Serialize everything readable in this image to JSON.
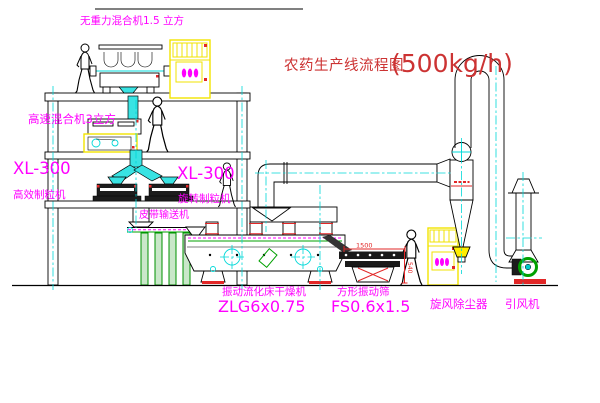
{
  "drawing": {
    "title": "农药生产线流程图",
    "capacity": "(500kg/h)"
  },
  "labels": {
    "zero_gravity_mixer": "无重力混合机1.5 立方",
    "high_speed_mixer": "高速混合机3立方",
    "granulator_left_model": "XL-300",
    "granulator_left_name": "高效制粒机",
    "granulator_right_model": "XL-300",
    "granulator_right_name": "旋转制粒机",
    "belt_conveyor": "皮带输送机",
    "fluid_bed_dryer_name": "振动流化床干燥机",
    "fluid_bed_dryer_model": "ZLG6x0.75",
    "vibrating_sieve_name": "方形振动筛",
    "vibrating_sieve_model": "FS0.6x1.5",
    "cyclone_dust_collector": "旋风除尘器",
    "induced_draft_fan": "引风机"
  },
  "dimensions": {
    "sieve_length": "1500",
    "sieve_height": "540"
  },
  "colors": {
    "label": "#ff00ff",
    "title": "#cc3333",
    "dimension": "#e22727",
    "centerline": "#00d8d8",
    "equipment_yellow": "#f2e300",
    "equipment_green": "#00a000"
  }
}
